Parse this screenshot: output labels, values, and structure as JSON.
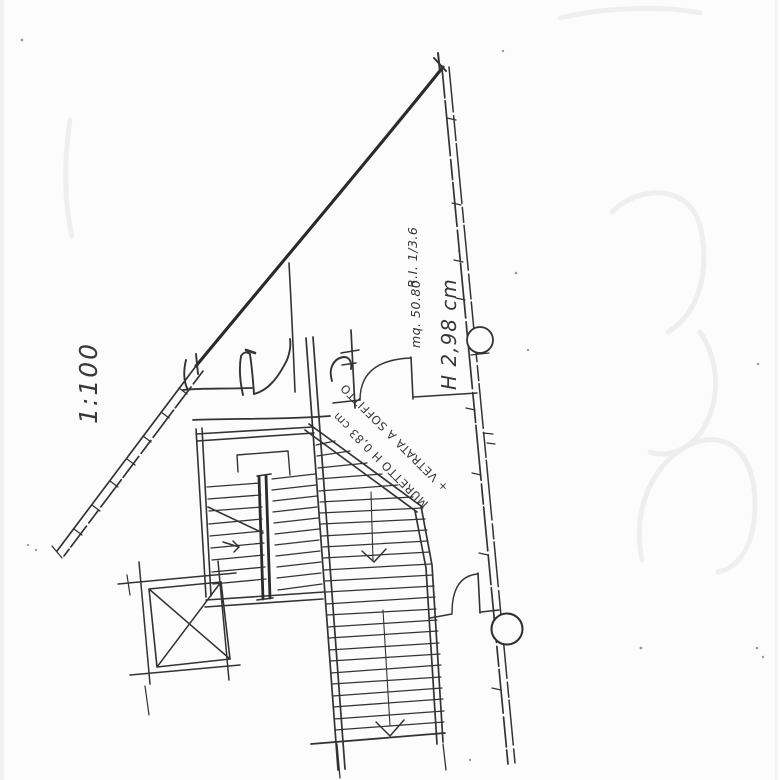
{
  "page": {
    "background_color": "#fcfcfc",
    "ink_color": "#333333",
    "ghost_color": "#ededed"
  },
  "plan": {
    "scale": "1:100",
    "room": {
      "area": "mq. 50.80",
      "illumination_ratio": "R.I. 1/3.6",
      "height": "H 2,98 cm"
    },
    "wall_annotation": {
      "line1": "MURETTO H 0,83 cm",
      "line2": "+ VETRATA A SOFFITTO"
    }
  }
}
